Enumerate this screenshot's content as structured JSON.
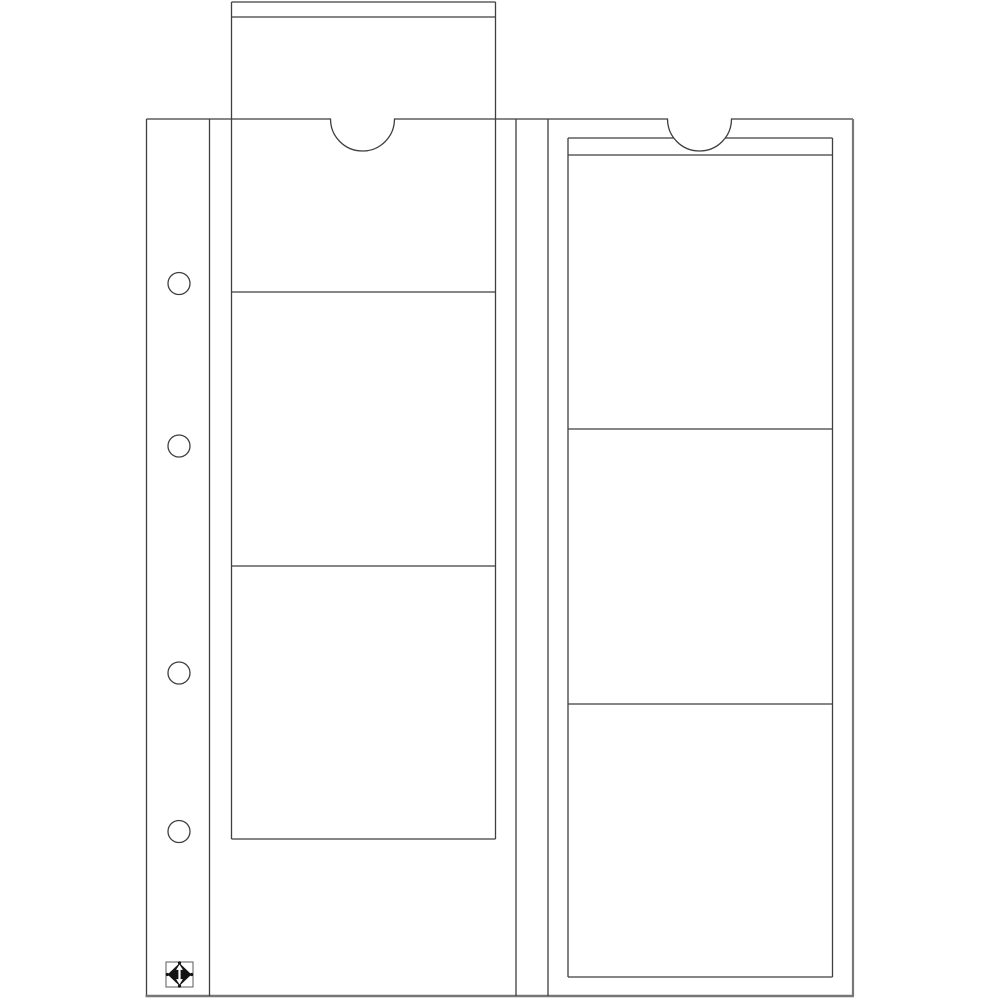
{
  "illustration": {
    "subject": "coin-album-pocket-sheet-line-drawing",
    "description_label": "Transparent 2-column coin pocket page with one insert card partially removed",
    "canvas": {
      "width": 1000,
      "height": 1000,
      "background": "#ffffff"
    },
    "palette": {
      "line": "#3f3f3f",
      "soft_edge": "#777777",
      "logo_black": "#141414",
      "logo_border": "#5a5a5a",
      "white": "#ffffff"
    },
    "stroke_widths": {
      "line": 1.3,
      "right_edge": 2.2,
      "bottom_edge": 2.6,
      "logo_box": 1.0
    },
    "sheet": {
      "left": 146.5,
      "top": 119,
      "right": 853,
      "bottom": 996,
      "binder_strip_divider_x": 209.5,
      "pocket_rails_x": [
        516,
        548
      ]
    },
    "thumb_notches": [
      {
        "name": "left-pocket-notch",
        "cx": 362.5,
        "r": 32
      },
      {
        "name": "right-pocket-notch",
        "cx": 699.5,
        "r": 32
      }
    ],
    "binder_holes": {
      "count": 4,
      "cx": 179,
      "r": 11,
      "cys": [
        283.5,
        446,
        673,
        831.5
      ]
    },
    "insert_cards": [
      {
        "name": "left-card-partially-removed",
        "x1": 231.5,
        "x2": 495.5,
        "top": 2,
        "header_line_y": 17,
        "section_lines_y": [
          292,
          566
        ],
        "bottom": 839,
        "top_gap": null
      },
      {
        "name": "right-card-fully-inserted",
        "x1": 568,
        "x2": 832.5,
        "top": 138,
        "header_line_y": 155,
        "section_lines_y": [
          429,
          704
        ],
        "bottom": 977,
        "top_gap": [
          674,
          725
        ]
      }
    ],
    "logo": {
      "name": "leuchtturm-diamond-logo",
      "box": {
        "x": 166,
        "y": 962,
        "w": 27,
        "h": 25
      },
      "diamond_rx": 11.5,
      "diamond_ry": 11,
      "corner_dot_r": 1.6
    }
  }
}
